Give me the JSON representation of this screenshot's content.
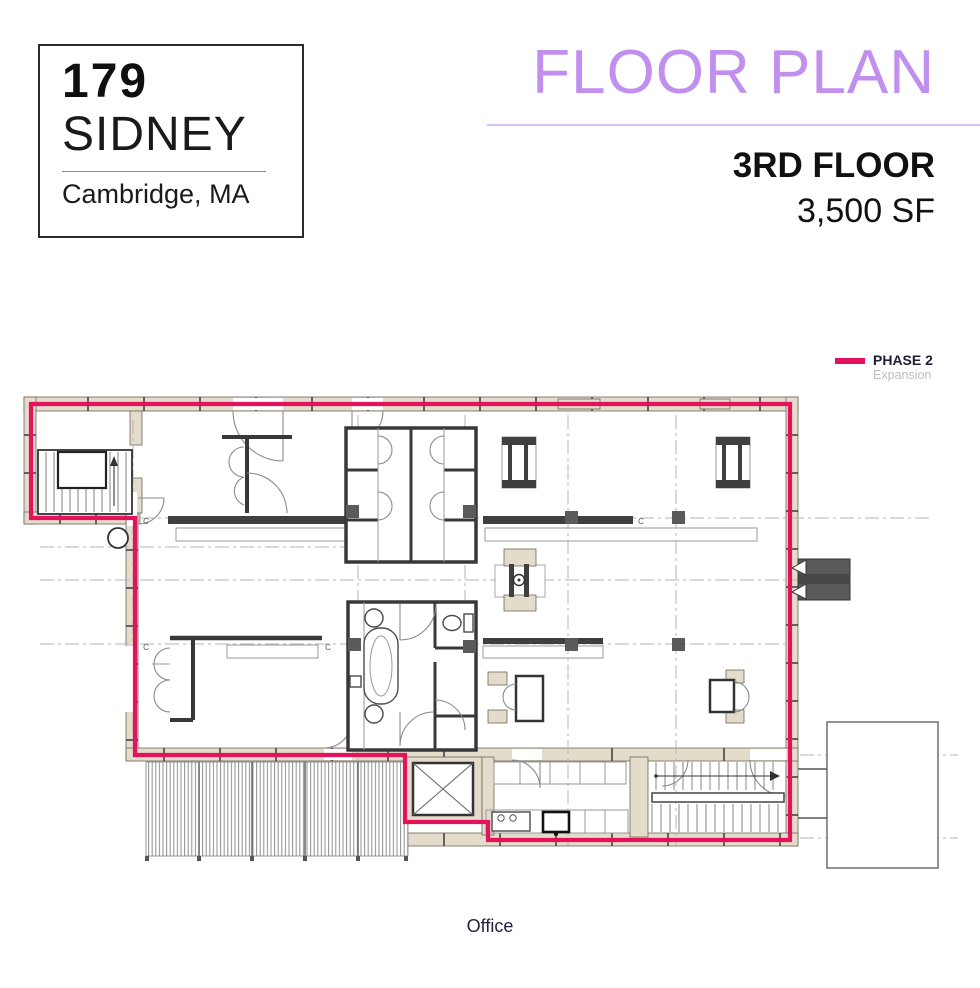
{
  "colors": {
    "accent_pink": "#e4125c",
    "accent_purple": "#c18fee",
    "underline_purple": "#d8c0f4",
    "wall_tan": "#e4dcca",
    "dark_text": "#1e1e38",
    "muted_text": "#bdbdbd"
  },
  "logo": {
    "number": "179",
    "name": "SIDNEY",
    "city": "Cambridge, MA"
  },
  "header": {
    "title": "FLOOR PLAN",
    "floor": "3RD FLOOR",
    "area": "3,500 SF"
  },
  "legend": {
    "phase": "PHASE 2",
    "phase_sub": "Expansion"
  },
  "plan": {
    "grid_label": "C"
  },
  "footer": {
    "room_label": "Office"
  }
}
